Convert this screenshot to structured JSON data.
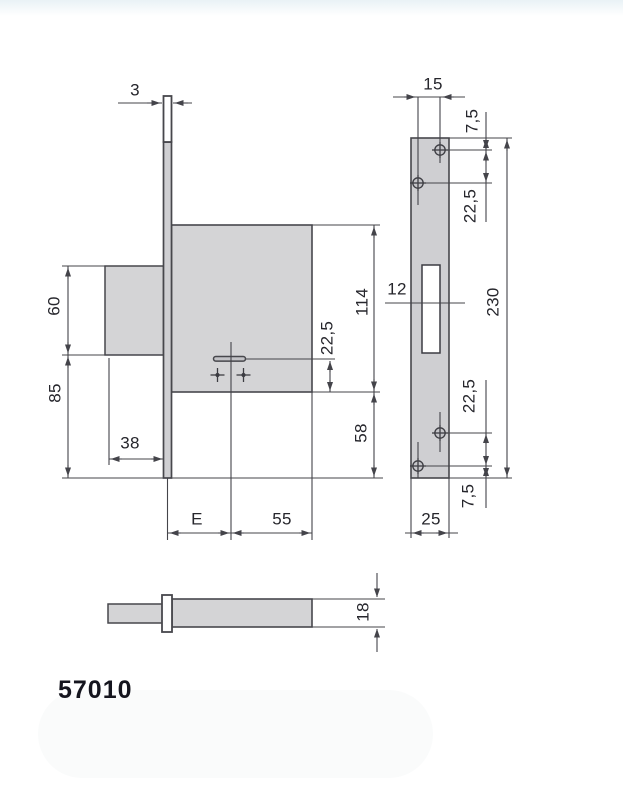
{
  "product_code": "57010",
  "colors": {
    "part_fill": "#d4d4d6",
    "plate_fill": "#cfcfd2",
    "line": "#44444a",
    "text": "#26262c",
    "background": "#ffffff"
  },
  "views": {
    "side_view": {
      "name": "lock-case-side-view",
      "labels": {
        "faceplate_thickness": "3",
        "box_to_axis_height": "60",
        "axis_to_plate_bottom": "85",
        "box_depth": "38",
        "case_height": "114",
        "axis_to_case_bottom": "22,5",
        "case_bottom_extension": "58",
        "backset": "E",
        "case_depth": "55"
      }
    },
    "front_view": {
      "name": "faceplate-front-view",
      "labels": {
        "screw_horizontal_offset": "15",
        "top_to_first_screw": "7,5",
        "screw_pitch_top": "22,5",
        "keyway_width": "12",
        "faceplate_height": "230",
        "screw_pitch_bottom": "22,5",
        "last_screw_to_bottom": "7,5",
        "faceplate_width": "25"
      }
    },
    "bottom_view": {
      "name": "lock-case-bottom-view",
      "labels": {
        "case_thickness": "18"
      }
    }
  }
}
